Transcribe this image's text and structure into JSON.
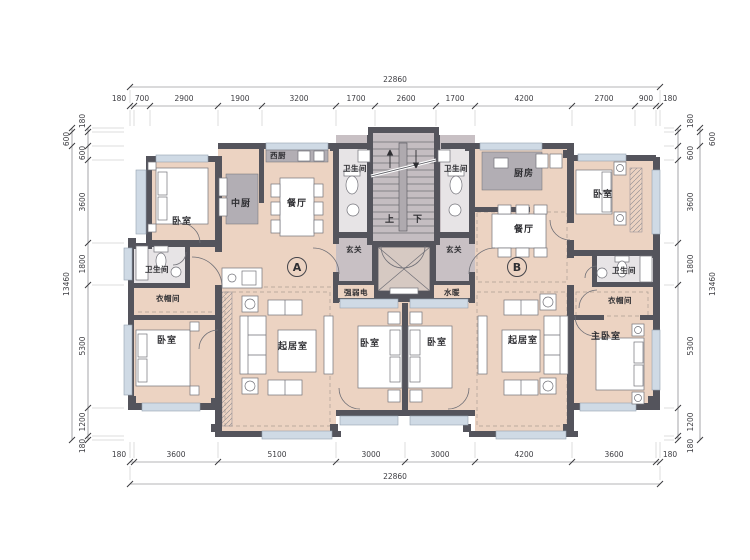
{
  "drawing_type": "residential floor plan",
  "dimensions": {
    "top": {
      "overall": "22860",
      "segments": [
        "180",
        "700",
        "2900",
        "1900",
        "3200",
        "1700",
        "2600",
        "1700",
        "4200",
        "2700",
        "900",
        "180"
      ]
    },
    "bottom": {
      "overall": "22860",
      "segments": [
        "180",
        "3600",
        "5100",
        "3000",
        "3000",
        "4200",
        "3600",
        "180"
      ]
    },
    "left": {
      "overall": "13460",
      "outer": "600",
      "segments": [
        "180",
        "600",
        "3600",
        "1800",
        "5300",
        "1200",
        "180"
      ]
    },
    "right": {
      "overall": "13460",
      "outer": "600",
      "segments": [
        "180",
        "600",
        "3600",
        "1800",
        "5300",
        "1200",
        "180"
      ]
    }
  },
  "units": {
    "a": {
      "label": "A",
      "bedroom_top": "卧室",
      "west_kitchen": "西厨",
      "kitchen": "中厨",
      "dining": "餐厅",
      "bath_core": "卫生间",
      "entry": "玄关",
      "elec": "强弱电",
      "bath_side": "卫生间",
      "cloak": "衣帽间",
      "bedroom_bottom": "卧室",
      "living": "起居室",
      "bedroom_mid": "卧室"
    },
    "b": {
      "label": "B",
      "bath_core": "卫生间",
      "kitchen": "厨房",
      "dining": "餐厅",
      "entry": "玄关",
      "plumbing": "水暖",
      "bedroom_top": "卧室",
      "bath_side": "卫生间",
      "cloak": "衣帽间",
      "master": "主卧室",
      "living": "起居室",
      "bedroom_mid": "卧室"
    }
  },
  "core": {
    "up": "上",
    "down": "下"
  },
  "colors": {
    "room_fill": "#ecd3c2",
    "core_fill": "#c8c0c4",
    "wall": "#54545c",
    "counter": "#b2aeb4",
    "window_sill": "#cfdae5"
  }
}
